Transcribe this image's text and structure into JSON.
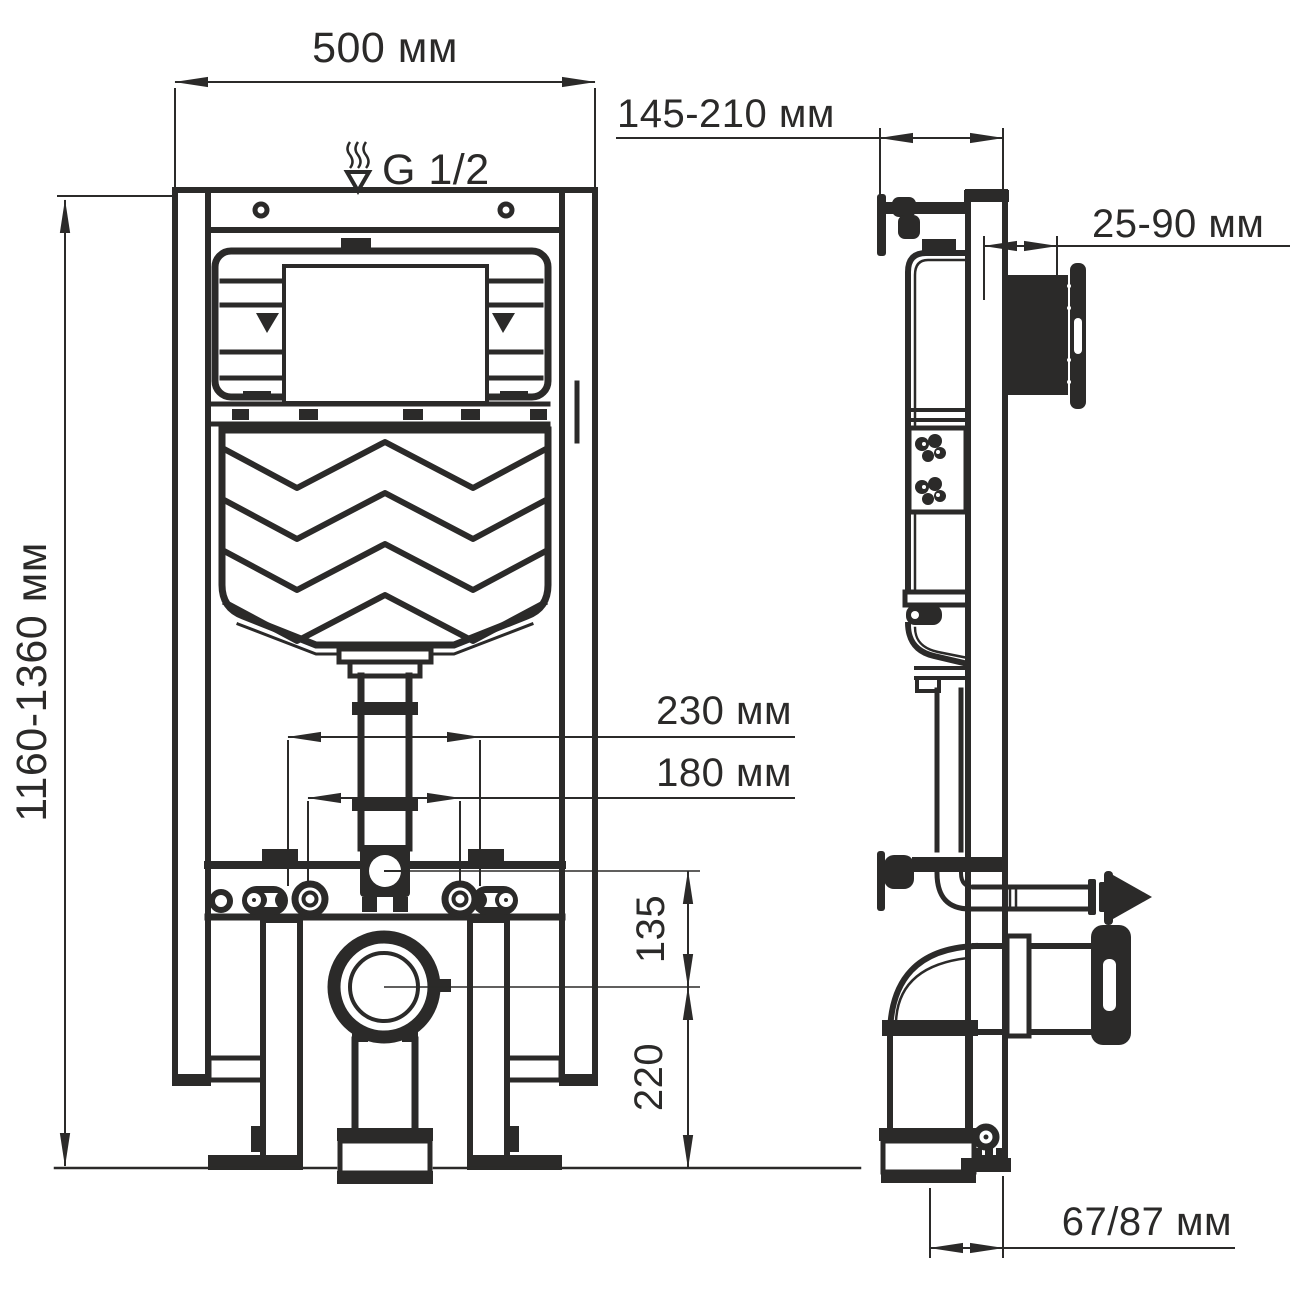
{
  "meta": {
    "type": "technical-dimension-drawing",
    "subject": "concealed WC cistern installation frame",
    "views": [
      "front",
      "side"
    ]
  },
  "colors": {
    "line": "#2b2a29",
    "background": "#ffffff"
  },
  "dimensions": {
    "width": {
      "label": "500 мм"
    },
    "water_inlet": {
      "label": "G 1/2"
    },
    "depth": {
      "label": "145-210 мм"
    },
    "plate_depth": {
      "label": "25-90 мм"
    },
    "height": {
      "label": "1160-1360 мм"
    },
    "span_230": {
      "label": "230 мм"
    },
    "span_180": {
      "label": "180 мм"
    },
    "drop_135": {
      "label": "135"
    },
    "drop_220": {
      "label": "220"
    },
    "outlet_offset": {
      "label": "67/87 мм"
    }
  }
}
